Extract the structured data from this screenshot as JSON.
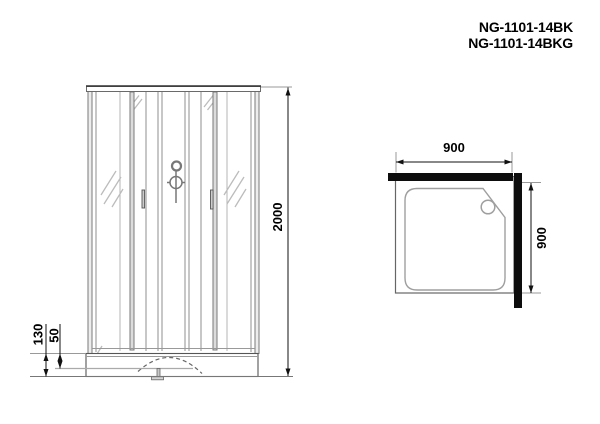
{
  "title": {
    "model_line_1": "NG-1101-14BK",
    "model_line_2": "NG-1101-14BKG"
  },
  "front_view": {
    "height_dim": "2000",
    "base_height_dim": "130",
    "base_step_dim": "50"
  },
  "plan_view": {
    "width_dim": "900",
    "depth_dim": "900"
  },
  "colors": {
    "outline": "#555555",
    "glass_line": "#8f8f8f",
    "reflection": "#bcbcbc",
    "dimension": "#111111",
    "wall_fill": "#0d0d0d",
    "background": "#ffffff",
    "text": "#000000"
  }
}
